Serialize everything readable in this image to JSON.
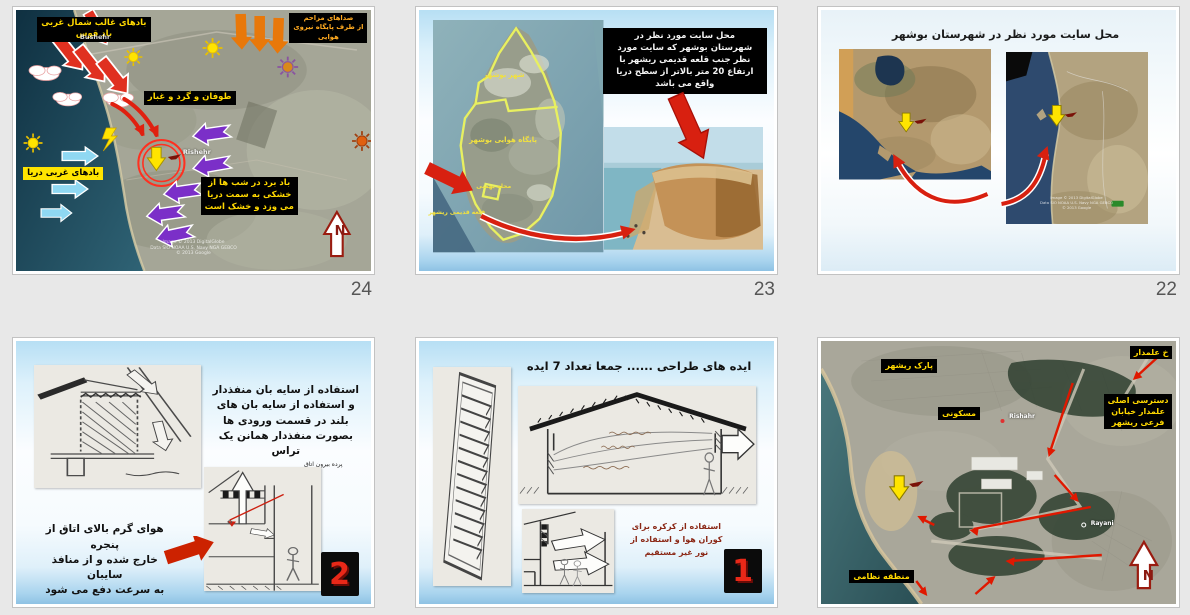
{
  "palette": {
    "page_bg": "#e8e8e8",
    "red_arrow": "#e03020",
    "orange_arrow": "#e8780a",
    "purple_arrow": "#7b2fc8",
    "cyan_arrow": "#8fd8f2",
    "yellow_accent": "#ffe400",
    "label_bg": "#000000",
    "label_yellow": "#ffd800",
    "number_red": "#e82818",
    "slide_number_gray": "#565656"
  },
  "slides": {
    "s24": {
      "number": "24",
      "nw_wind": "بادهای غالب شمال غربی\nباد قوس",
      "noise": "صداهای مزاحم\nاز طرف پایگاه نیروی\nهوایی",
      "storm": "طوفان و گرد و غبار",
      "sea_wind": "بادهای غربی دریا",
      "night_wind": "باد برد در شب ها از\nخشکی به سمت دریا\nمی وزد و خشک است",
      "city1": "Bushehr",
      "city2": "Rishehr",
      "credits": "Image © 2013 DigitalGlobe\nData SIO NOAA U.S. Navy NGA GEBCO\n© 2013 Google",
      "compass": "N"
    },
    "s23": {
      "number": "23",
      "desc": "محل سایت مورد نظر در\nشهرستان بوشهر که سایت مورد\nنظر جنب قلعه قدیمی ریشهر با\nارتفاع 20 متر بالاتر از سطح دریا\nواقع می باشد",
      "city": "شهر بوشهر",
      "airbase": "پایگاه هوایی بوشهر",
      "district": "محله بهمنی",
      "castle": "قلعه قدیمی ریشهر"
    },
    "s22": {
      "number": "22",
      "title": "محل سایت مورد نظر در شهرستان بوشهر",
      "credits": "Image © 2013 DigitalGlobe\nData SIO NOAA U.S. Navy NGA GEBCO\n© 2013 Google"
    },
    "s2": {
      "number": "2",
      "shade_text": "استفاده از سایه بان منفذدار\nو استفاده از سایه بان های\nبلند در قسمت ورودی ها\nبصورت منفذدار همانن یک\nتراس",
      "curtain": "پرده بیرون اتاق",
      "hot_air": "هوای گرم بالای اتاق از پنجره\nخارج شده و از منافذ سایبان\nبه سرعت دفع می شود"
    },
    "s1": {
      "number": "1",
      "title": "ایده های طراحی ...... جمعا تعداد 7 ایده",
      "louver_note": "استفاده از کرکره برای\nکوران هوا و استفاده از\nنور غیر مستقیم"
    },
    "smap": {
      "alamdar": "خ علمدار",
      "park": "پارک ریشهر",
      "residential": "مسکونی",
      "access": "دسترسی اصلی\nعلمدار خیابان\nفرعی ریشهر",
      "military": "منطقه نظامی",
      "city1": "Rishahr",
      "city2": "Rayani",
      "compass": "N"
    }
  }
}
